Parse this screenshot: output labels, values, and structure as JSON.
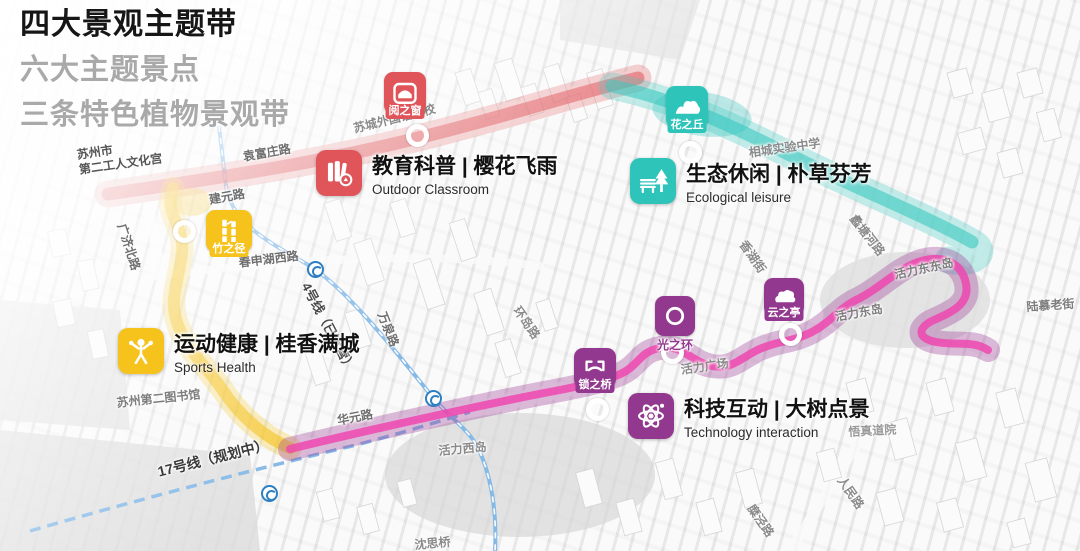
{
  "titles": [
    "四大景观主题带",
    "六大主题景点",
    "三条特色植物景观带"
  ],
  "themes": [
    {
      "cjk": "教育科普 | 樱花飞雨",
      "en": "Outdoor Classroom",
      "color": "#e0555a",
      "icon": "books-icon"
    },
    {
      "cjk": "生态休闲 | 朴草芬芳",
      "en": "Ecological leisure",
      "color": "#2ec4ba",
      "icon": "bench-tree-icon"
    },
    {
      "cjk": "运动健康 | 桂香满城",
      "en": "Sports Health",
      "color": "#f6c31d",
      "icon": "sports-person-icon"
    },
    {
      "cjk": "科技互动 | 大树点景",
      "en": "Technology interaction",
      "color": "#93388f",
      "icon": "atom-icon"
    }
  ],
  "nodes": [
    {
      "label": "阅之窗",
      "color": "#e0555a",
      "icon": "window-arch-icon"
    },
    {
      "label": "花之丘",
      "color": "#2ec4ba",
      "icon": "hills-icon"
    },
    {
      "label": "竹之径",
      "color": "#f6c31d",
      "icon": "bamboo-icon"
    },
    {
      "label": "锁之桥",
      "color": "#93388f",
      "icon": "bridge-icon"
    },
    {
      "label": "光之环",
      "color": "#93388f",
      "icon": "ring-icon"
    },
    {
      "label": "云之亭",
      "color": "#93388f",
      "icon": "cloud-icon"
    }
  ],
  "map_labels": [
    {
      "text": "苏州市\n第二工人文化宫"
    },
    {
      "text": "袁富庄路"
    },
    {
      "text": "苏城外国语学校"
    },
    {
      "text": "建元路"
    },
    {
      "text": "广济北路"
    },
    {
      "text": "春申湖西路"
    },
    {
      "text": "相城实验中学"
    },
    {
      "text": "蠡塘河路"
    },
    {
      "text": "香湖街"
    },
    {
      "text": "万泉路"
    },
    {
      "text": "环岛路"
    },
    {
      "text": "4号线（已运营）"
    },
    {
      "text": "17号线（规划中）"
    },
    {
      "text": "华元路"
    },
    {
      "text": "苏州第二图书馆"
    },
    {
      "text": "活力西岛"
    },
    {
      "text": "活力广场"
    },
    {
      "text": "活力东岛"
    },
    {
      "text": "活力东东岛"
    },
    {
      "text": "陆慕老街"
    },
    {
      "text": "悟真道院"
    },
    {
      "text": "人民路"
    },
    {
      "text": "糜泾路"
    },
    {
      "text": "沈思桥"
    }
  ],
  "palette": {
    "education_red": "#e0555a",
    "ecology_teal": "#2ec4ba",
    "sports_yellow": "#f6c31d",
    "technology_purple": "#93388f",
    "route_pink": "#ee46ae",
    "metro_blue": "#85b9e6"
  }
}
